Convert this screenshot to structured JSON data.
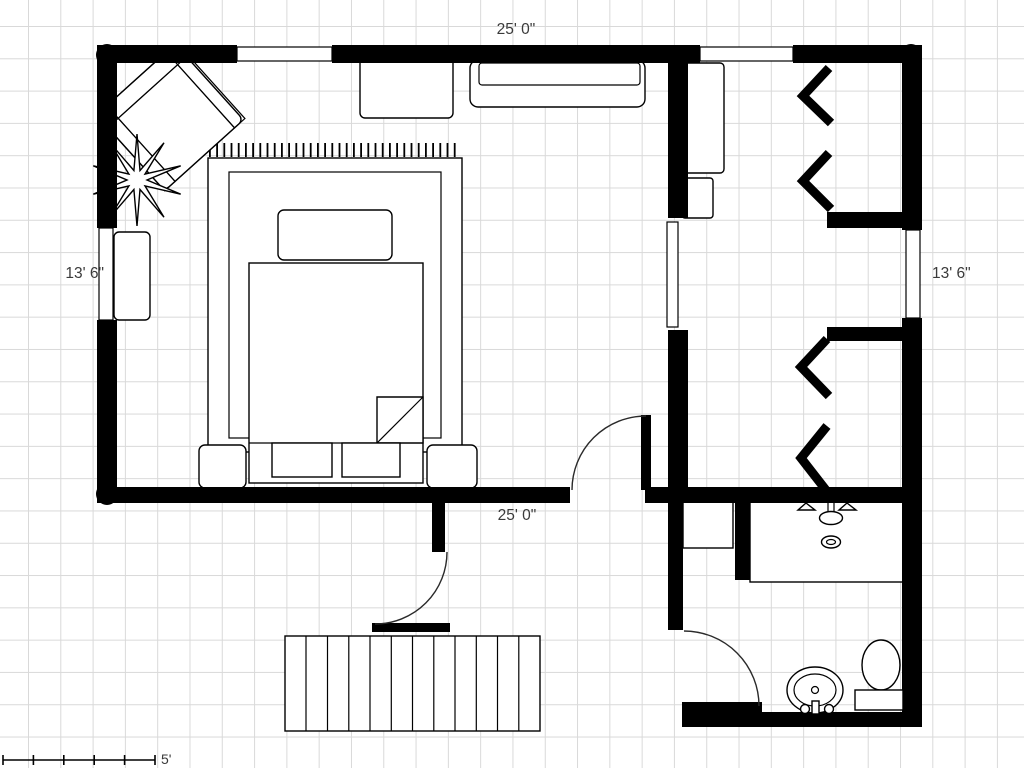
{
  "dimension_labels": {
    "top": "25' 0\"",
    "bottom": "25' 0\"",
    "left": "13' 6\"",
    "right": "13' 6\""
  },
  "scale_bar": {
    "label": "5'"
  },
  "colors": {
    "wall": "#000000",
    "grid_line": "#d9d9d9",
    "background": "#ffffff",
    "text": "#3a3a3a"
  },
  "objects": [
    "exterior-wall",
    "interior-wall",
    "corner-post",
    "window",
    "wall-opening",
    "door-swing",
    "armchair",
    "potted-plant",
    "area-rug",
    "bed",
    "headboard",
    "foot-cushion",
    "turned-sheet-fold",
    "nightstand",
    "dresser",
    "media-console",
    "window-bench",
    "wardrobe-unit",
    "storage-unit",
    "hanging-rod-chevron",
    "bathroom-cabinet",
    "vanity-counter",
    "vanity-faucet",
    "vanity-drain",
    "pedestal-sink",
    "toilet",
    "deck",
    "scale-bar"
  ]
}
